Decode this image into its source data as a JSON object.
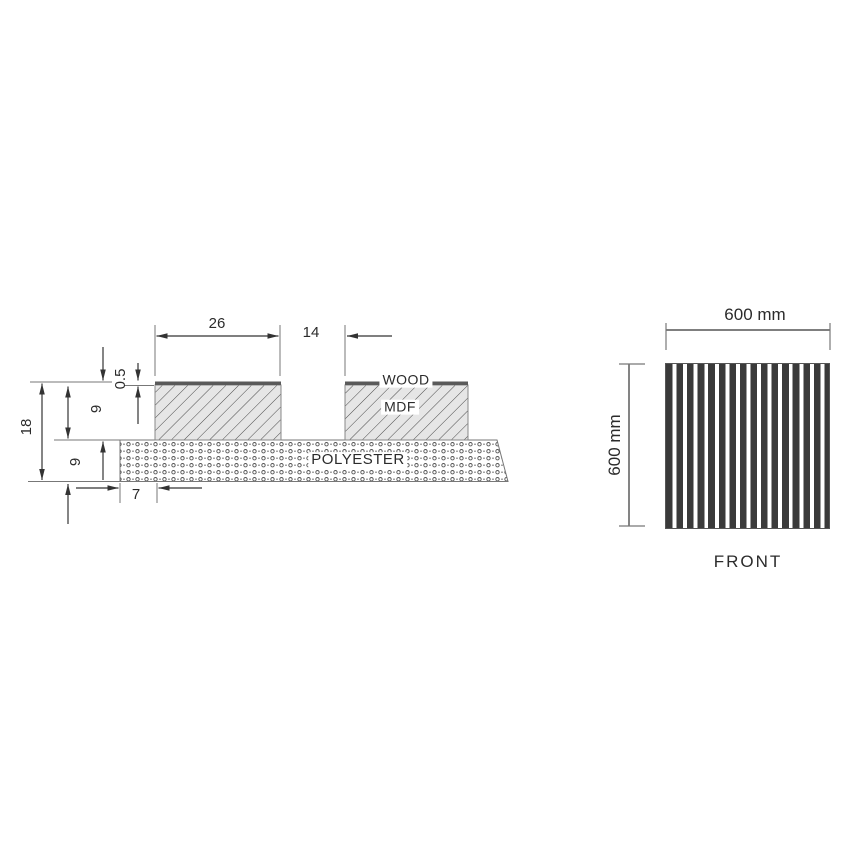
{
  "drawing": {
    "section": {
      "dim_slat_width": "26",
      "dim_gap": "14",
      "dim_veneer_thickness": "0.5",
      "dim_total_thickness": "18",
      "dim_mdf_thickness": "9",
      "dim_polyester_thickness": "9",
      "dim_edge_offset": "7",
      "label_wood": "WOOD",
      "label_mdf": "MDF",
      "label_polyester": "POLYESTER"
    },
    "front": {
      "dim_width": "600 mm",
      "dim_height": "600 mm",
      "caption": "FRONT"
    },
    "colors": {
      "line": "#333333",
      "extension_line": "#777777",
      "veneer": "#5a5a5a",
      "mdf_fill": "#e6e6e6",
      "stripe": "#3a3a3a",
      "background": "#ffffff"
    }
  }
}
